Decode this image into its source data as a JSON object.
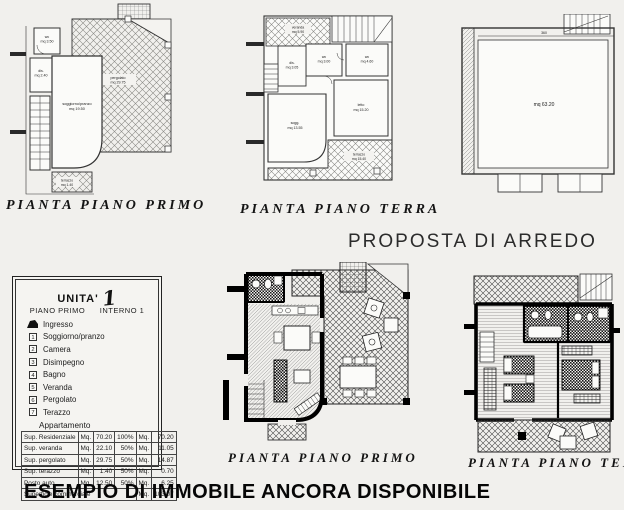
{
  "page": {
    "proposta_title": "PROPOSTA DI ARREDO",
    "footer": "ESEMPIO DI IMMOBILE ANCORA DISPONIBILE"
  },
  "plans": {
    "first_floor": {
      "caption": "PIANTA PIANO PRIMO",
      "rooms": {
        "wc": "wc",
        "wc_mq": "mq 3.50",
        "dis": "dis.",
        "dis_mq": "mq 2.40",
        "soggiorno": "soggiorno/pranzo",
        "soggiorno_mq": "mq 19.50",
        "pergolato": "pergolato",
        "pergolato_mq": "mq 29.75",
        "terrazzo": "terrazzo",
        "terrazzo_mq": "mq 1.40"
      }
    },
    "ground_floor": {
      "caption": "PIANTA PIANO TERRA",
      "rooms": {
        "veranda": "veranda",
        "veranda_mq": "mq 5.90",
        "wc1": "wc",
        "wc1_mq": "mq 3.00",
        "wc2": "wc",
        "wc2_mq": "mq 4.60",
        "dis": "dis.",
        "dis_mq": "mq 3.05",
        "letto": "letto",
        "letto_mq": "mq 15.20",
        "sogg": "sogg.",
        "sogg_mq": "mq 13.55",
        "terrazzo": "terrazzo",
        "terrazzo_mq": "mq 15.40"
      }
    },
    "garage": {
      "area_mq": "mq 63.20",
      "dim_top": "360"
    },
    "furnished_first": {
      "caption": "PIANTA PIANO PRIMO"
    },
    "furnished_ground": {
      "caption": "PIANTA PIANO TERRA"
    }
  },
  "legend": {
    "title": "UNITA'",
    "unit_number": "1",
    "floor_line": "PIANO PRIMO",
    "interno_line": "INTERNO 1",
    "entrance_label": "Ingresso",
    "items": [
      {
        "num": "1",
        "label": "Soggiorno/pranzo"
      },
      {
        "num": "2",
        "label": "Camera"
      },
      {
        "num": "3",
        "label": "Disimpegno"
      },
      {
        "num": "4",
        "label": "Bagno"
      },
      {
        "num": "5",
        "label": "Veranda"
      },
      {
        "num": "6",
        "label": "Pergolato"
      },
      {
        "num": "7",
        "label": "Terazzo"
      }
    ],
    "apartment_heading": "Appartamento",
    "table": {
      "rows": [
        {
          "label": "Sup. Residenziale",
          "u1": "Mq.",
          "v1": "70.20",
          "pct": "100%",
          "u2": "Mq.",
          "v2": "70.20"
        },
        {
          "label": "Sup. veranda",
          "u1": "Mq.",
          "v1": "22.10",
          "pct": "50%",
          "u2": "Mq.",
          "v2": "11.05"
        },
        {
          "label": "Sup. pergolato",
          "u1": "Mq.",
          "v1": "29.75",
          "pct": "50%",
          "u2": "Mq.",
          "v2": "14.87"
        },
        {
          "label": "Sup. terazzo",
          "u1": "Mq.",
          "v1": "1.40",
          "pct": "50%",
          "u2": "Mq.",
          "v2": "0.70"
        },
        {
          "label": "Posto auto",
          "u1": "Mq.",
          "v1": "12.50",
          "pct": "50%",
          "u2": "Mq.",
          "v2": "6.25"
        }
      ],
      "total_label": "Superficie commerciale",
      "total_unit": "Mq.",
      "total_value": "103.07"
    }
  }
}
